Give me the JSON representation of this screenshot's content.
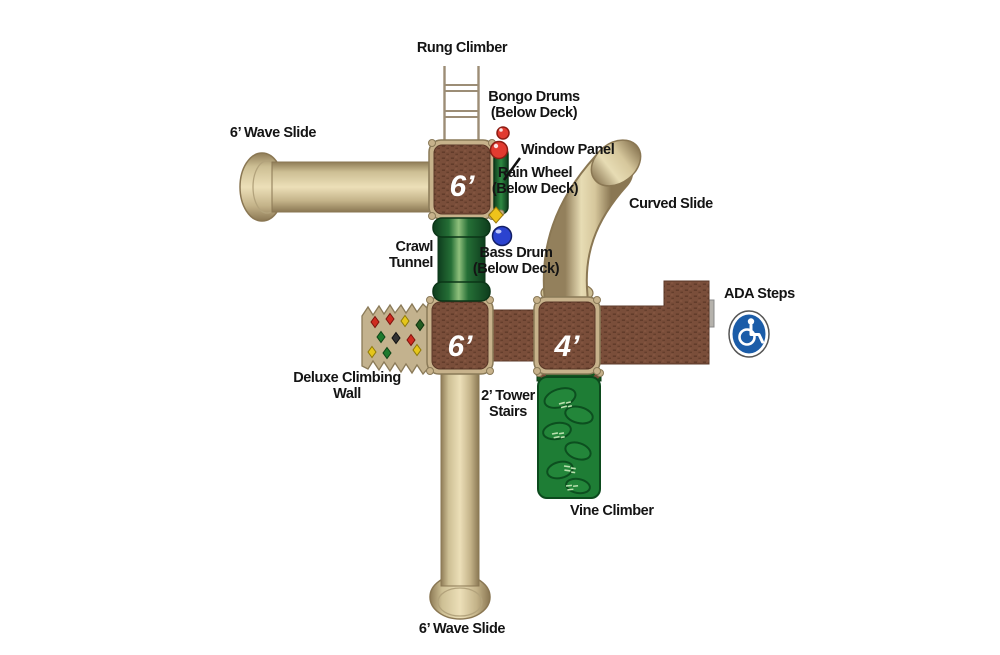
{
  "labels": {
    "rung_climber": "Rung Climber",
    "wave_slide_top": "6’ Wave Slide",
    "bongo_drums": [
      "Bongo Drums",
      "(Below Deck)"
    ],
    "window_panel": "Window Panel",
    "rain_wheel": [
      "Rain Wheel",
      "(Below Deck)"
    ],
    "curved_slide": "Curved Slide",
    "crawl_tunnel": [
      "Crawl",
      "Tunnel"
    ],
    "bass_drum": [
      "Bass Drum",
      "(Below Deck)"
    ],
    "ada_steps": "ADA Steps",
    "deluxe_climbing_wall": [
      "Deluxe Climbing",
      "Wall"
    ],
    "tower_stairs": [
      "2’ Tower",
      "Stairs"
    ],
    "vine_climber": "Vine Climber",
    "wave_slide_bottom": "6’ Wave Slide"
  },
  "decks": {
    "top": {
      "label": "6’"
    },
    "lower_left": {
      "label": "6’"
    },
    "lower_right": {
      "label": "4’"
    }
  },
  "icons": {
    "ada_wheelchair": "wheelchair-accessibility-symbol",
    "bongo_drums": "two-red-bongo-drums",
    "bass_drum": "blue-bass-drum-ball",
    "rain_wheel": "yellow-rain-wheel"
  },
  "colors": {
    "deck_brown": "#7A4E3A",
    "deck_frame_tan": "#C7B28B",
    "slide_tan": "#E7DCB4",
    "slide_edge_tan": "#8A7753",
    "tunnel_green": "#256F36",
    "vine_green": "#1E7D35",
    "bongo_red": "#E23B30",
    "bass_drum_blue": "#2B43CF",
    "ada_blue": "#1B5CA8",
    "hold_red": "#CF2B20",
    "hold_yellow": "#E5C61B",
    "hold_green": "#1E7A2E"
  }
}
